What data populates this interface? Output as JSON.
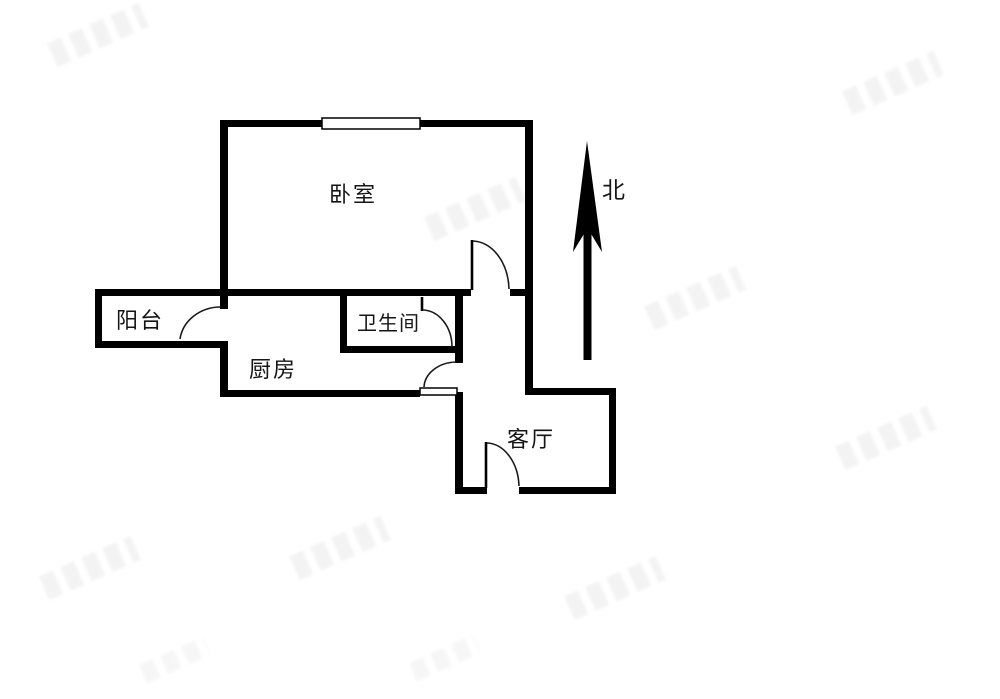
{
  "floorplan": {
    "background": "#ffffff",
    "wall_color": "#000000",
    "rooms": {
      "bedroom": {
        "label": "卧室"
      },
      "balcony": {
        "label": "阳台"
      },
      "kitchen": {
        "label": "厨房"
      },
      "bathroom": {
        "label": "卫生间"
      },
      "living_room": {
        "label": "客厅"
      }
    },
    "compass": {
      "label": "北",
      "direction": "up"
    },
    "openings": {
      "windows": 1,
      "door_arcs": 5
    }
  },
  "watermarks": {
    "present": true,
    "legible": false,
    "count": 10
  }
}
